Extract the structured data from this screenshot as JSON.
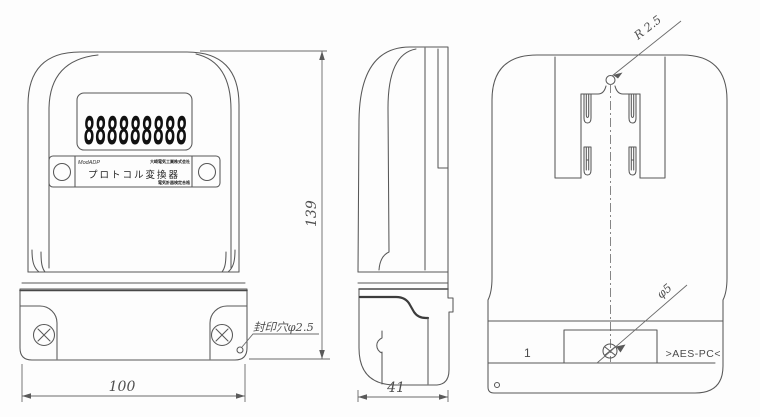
{
  "drawing": {
    "title": "protocol-converter three-view dimensional drawing",
    "front_view": {
      "display_value": "888888888",
      "nameplate": {
        "brand": "ModADP",
        "maker_top": "大崎電気工業株式会社",
        "product": "プロトコル変換器",
        "maker_bottom": "電気計器検定合格"
      },
      "seal_hole_label": "封印穴φ2.5",
      "width_dim": "100",
      "height_dim": "139"
    },
    "side_view": {
      "depth_dim": "41"
    },
    "back_view": {
      "radius_label": "R 2.5",
      "hole_label": "φ5",
      "mold_number": "1",
      "material_marking": ">AES-PC<"
    }
  }
}
